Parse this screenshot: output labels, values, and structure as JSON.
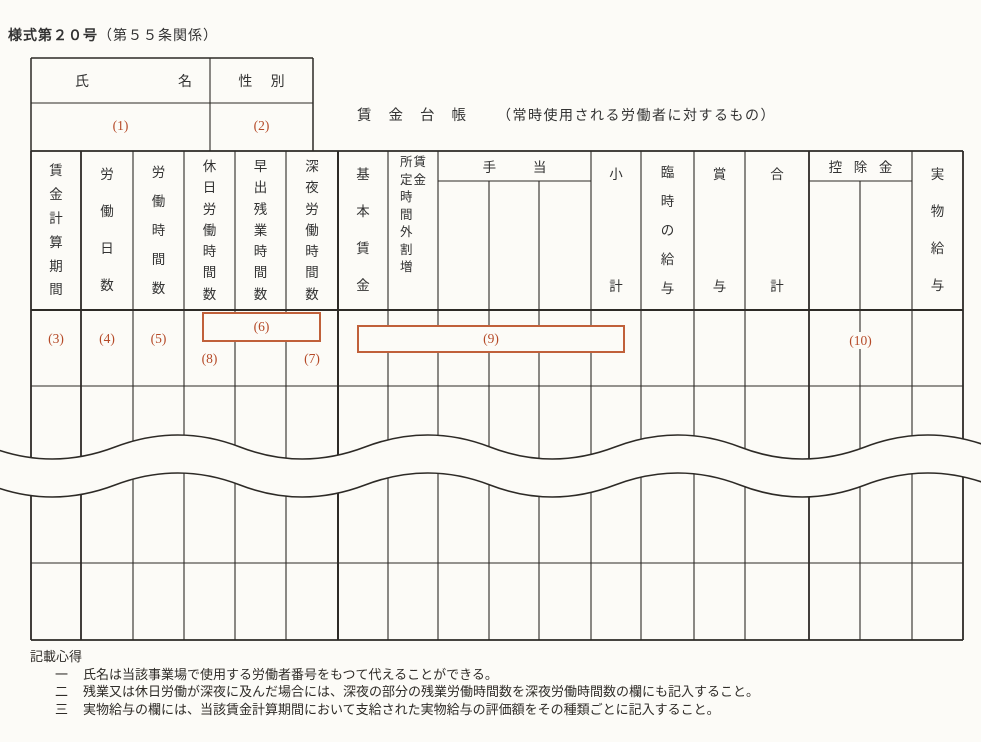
{
  "colors": {
    "accent": "#b54a28",
    "line": "#2d2a26",
    "background": "#fcfbf7"
  },
  "form_header": {
    "form_number": "様式第２０号",
    "regulation_ref": "（第５５条関係）"
  },
  "title": {
    "main": "賃金台帳",
    "note": "（常時使用される労働者に対するもの）"
  },
  "name_table": {
    "name_label": "氏名",
    "sex_label": "性別",
    "name_ref": "(1)",
    "sex_ref": "(2)"
  },
  "table": {
    "headers": {
      "period": "賃金計算期間",
      "work_days": "労働日数",
      "work_hours": "労働時間数",
      "holiday_work_hours": "休日労働時間数",
      "early_overtime_hours": "早出残業時間数",
      "late_night_hours": "深夜労働時間数",
      "base_wage": "基本賃金",
      "overtime_premium_line_right": "賃金",
      "overtime_premium_line_left": "所定時間外割増",
      "allowances": "手当",
      "subtotal": "小計",
      "temporary_pay": "臨時の給与",
      "bonus": "賞与",
      "total": "合計",
      "deductions": "控除金",
      "payment_in_kind": "実物給与"
    },
    "refs": {
      "period": "(3)",
      "work_days": "(4)",
      "work_hours": "(5)",
      "overtime_box": "(6)",
      "late_night": "(7)",
      "holiday": "(8)",
      "wage_box": "(9)",
      "deductions": "(10)"
    }
  },
  "notes": {
    "heading": "記載心得",
    "items": [
      {
        "num": "一",
        "text": "氏名は当該事業場で使用する労働者番号をもつて代えることができる。"
      },
      {
        "num": "二",
        "text": "残業又は休日労働が深夜に及んだ場合には、深夜の部分の残業労働時間数を深夜労働時間数の欄にも記入すること。"
      },
      {
        "num": "三",
        "text": "実物給与の欄には、当該賃金計算期間において支給された実物給与の評価額をその種類ごとに記入すること。"
      }
    ]
  }
}
